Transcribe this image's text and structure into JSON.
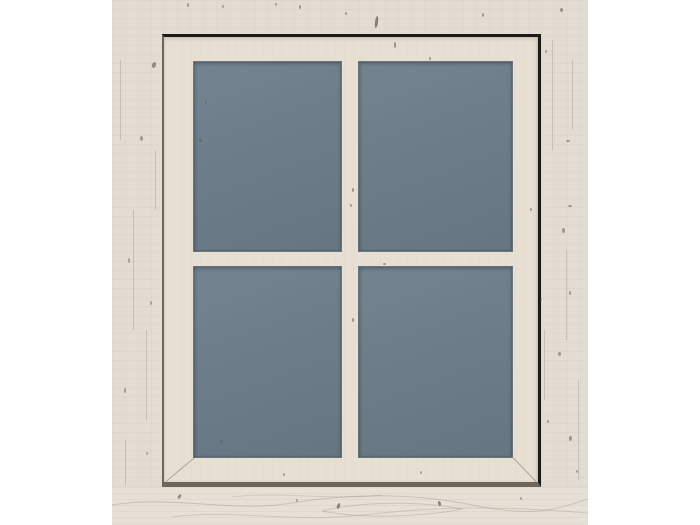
{
  "image": {
    "type": "product-photo",
    "description": "Whitewashed wooden cabin wall with a square wooden casement window holding four tinted grey-blue glass panes in a 2 by 2 cross-mullion layout",
    "wall_label": "whitewashed wood wall",
    "frame_label": "wooden window frame",
    "glass_label": "tinted glazing"
  },
  "palette": {
    "background": "#ffffff",
    "wall": "#e2dcd2",
    "wall_bottom": "#e6e0d6",
    "frame": "#e7e0d2",
    "glass": "#6b7d8a",
    "edge_dark": "#1a1a1a",
    "edge_soft": "#6f665a",
    "knot": "#60564a",
    "grain": "#968a74"
  },
  "window": {
    "pane_count": 4,
    "rows": 2,
    "cols": 2,
    "glazing": "tinted grey-blue"
  }
}
